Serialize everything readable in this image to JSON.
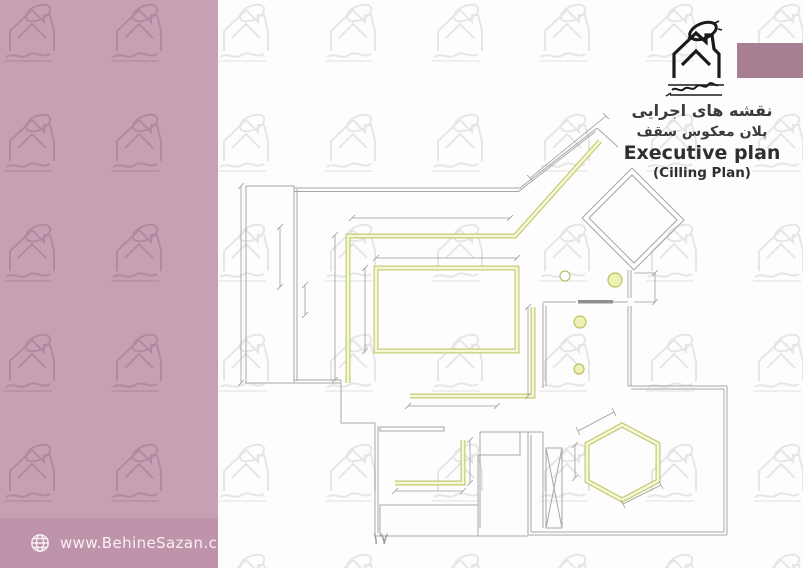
{
  "page": {
    "title_fa_line1": "نقشه های اجرایی",
    "title_fa_line2": "پلان معکوس سقف",
    "title_en": "Executive plan",
    "title_en_sub": "(Cilling Plan)",
    "page_number": "۱۷"
  },
  "footer": {
    "website": "www.BehineSazan.co",
    "globe_icon": "globe-icon"
  },
  "branding": {
    "logo_icon": "behinesazan-house-logo",
    "watermark_icon": "behinesazan-house-watermark",
    "accent_rect_color": "#a87e93"
  },
  "colors": {
    "sidebar_pink": "#c7a1b3",
    "footer_bar_pink": "#bf93a9",
    "accent_rect": "#a87e93",
    "ceiling_line_olive": "#c6cb72",
    "ceiling_fill_pale": "#f6f6d8",
    "wall_gray": "#a6a6a6",
    "dimension_gray": "#9b9b9b",
    "watermark_on_white": "#e6e6e6",
    "watermark_on_pink": "#b28aa0",
    "title_text": "#3b3b3b",
    "page_number_text": "#9b9b9b",
    "footer_text": "#f8f0f4"
  },
  "plan": {
    "description_label": "reflected ceiling plan drawing",
    "light_count": 4,
    "ceiling_features": [
      "large-L-cornice-with-diagonal",
      "central-rectangle-tray",
      "right-L-cornice",
      "small-L-cornice",
      "hexagon-tray"
    ]
  }
}
